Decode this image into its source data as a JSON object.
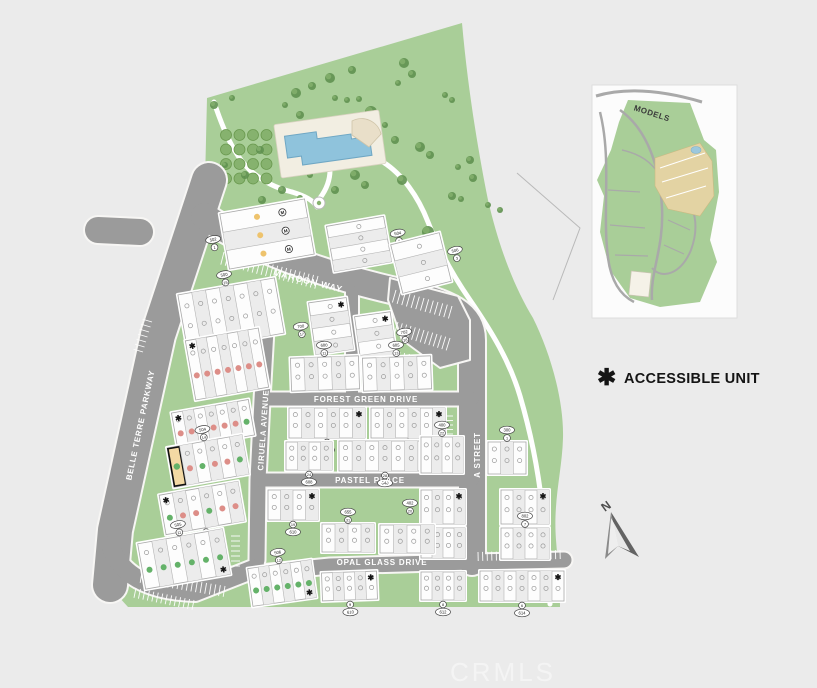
{
  "watermark": {
    "text": "CRMLS"
  },
  "legend": {
    "star": "✱",
    "label": "ACCESSIBLE UNIT"
  },
  "compass": {
    "label": "N"
  },
  "inset": {
    "title": "MODELS"
  },
  "streets": [
    {
      "name": "MAROON WAY"
    },
    {
      "name": "FOREST GREEN DRIVE"
    },
    {
      "name": "PASTEL PLACE"
    },
    {
      "name": "OPAL GLASS DRIVE"
    },
    {
      "name": "BELLE TERRE PARKWAY"
    },
    {
      "name": "CIRUELA AVENUE"
    },
    {
      "name": "A STREET"
    }
  ],
  "colors": {
    "background": "#ebebeb",
    "site_green": "#a9ce98",
    "road_gray": "#9b9b9b",
    "building_white": "#fdfdfd",
    "unit_alt": "#ececec",
    "sold_red": "#dd8e88",
    "available_green": "#64b269",
    "model_yellow": "#eec36d",
    "highlight_tan": "#f3d9a4",
    "pool_blue": "#8fc3dc",
    "deck_cream": "#f2eee2",
    "tree_dark": "#5f9150",
    "tree_light": "#86b26e",
    "accent_black": "#141414"
  },
  "map": {
    "buildings": [
      {
        "x": 224,
        "y": 206,
        "w": 86,
        "h": 56,
        "rot": -10,
        "o": "h",
        "n": 3,
        "dots": [
          "model",
          "model",
          "model"
        ],
        "lab": {
          "t": "502",
          "num": "1",
          "s": "left"
        }
      },
      {
        "x": 330,
        "y": 221,
        "w": 58,
        "h": 46,
        "rot": -10,
        "o": "h",
        "n": 4,
        "lab": {
          "t": "504",
          "num": "2",
          "s": "right"
        }
      },
      {
        "x": 396,
        "y": 238,
        "w": 50,
        "h": 50,
        "rot": -14,
        "o": "h",
        "n": 3,
        "lab": {
          "t": "506",
          "num": "3",
          "s": "right"
        }
      },
      {
        "x": 182,
        "y": 286,
        "w": 98,
        "h": 56,
        "rot": -10,
        "o": "v",
        "n": 7,
        "lab": {
          "t": "500",
          "num": "15",
          "s": "top"
        }
      },
      {
        "x": 312,
        "y": 300,
        "w": 38,
        "h": 52,
        "rot": -8,
        "o": "h",
        "n": 4,
        "star": "tr",
        "lab": {
          "t": "700",
          "num": "17",
          "s": "left"
        }
      },
      {
        "x": 358,
        "y": 314,
        "w": 36,
        "h": 52,
        "rot": -8,
        "o": "h",
        "n": 4,
        "star": "tr",
        "lab": {
          "t": "702",
          "num": "18",
          "s": "right"
        }
      },
      {
        "x": 190,
        "y": 334,
        "w": 74,
        "h": 60,
        "rot": -10,
        "o": "v",
        "n": 7,
        "dots": [
          "red",
          "red",
          "red",
          "red",
          "red",
          "red",
          "red"
        ],
        "star": "tl"
      },
      {
        "x": 174,
        "y": 406,
        "w": 78,
        "h": 36,
        "rot": -10,
        "o": "v",
        "n": 7,
        "dots": [
          "red",
          "red",
          "red",
          "red",
          "red",
          "red",
          "green"
        ],
        "star": "tl",
        "lab": {
          "t": "502",
          "num": "15",
          "s": "bottom"
        }
      },
      {
        "x": 170,
        "y": 441,
        "w": 76,
        "h": 40,
        "rot": -10,
        "o": "v",
        "n": 6,
        "dots": [
          "hl",
          "red",
          "green",
          "red",
          "red",
          "green"
        ],
        "lab": {
          "t": "504",
          "num": "14",
          "s": "top"
        }
      },
      {
        "x": 162,
        "y": 488,
        "w": 80,
        "h": 40,
        "rot": -10,
        "o": "v",
        "n": 6,
        "dots": [
          "green",
          "red",
          "red",
          "green",
          "red",
          "red"
        ],
        "star": "tl",
        "lab": {
          "t": "400",
          "num": "13",
          "s": "bottom"
        }
      },
      {
        "x": 141,
        "y": 536,
        "w": 86,
        "h": 46,
        "rot": -10,
        "o": "v",
        "n": 6,
        "dots": [
          "green",
          "green",
          "green",
          "green",
          "green",
          "green"
        ],
        "star": "br",
        "lab": {
          "t": "505",
          "num": "11",
          "s": "top"
        }
      },
      {
        "x": 291,
        "y": 357,
        "w": 68,
        "h": 33,
        "rot": -2,
        "o": "v",
        "n": 5,
        "lab": {
          "t": "600",
          "num": "11",
          "s": "top"
        }
      },
      {
        "x": 363,
        "y": 357,
        "w": 68,
        "h": 33,
        "rot": -2,
        "o": "v",
        "n": 5,
        "lab": {
          "t": "605",
          "num": "13",
          "s": "top"
        }
      },
      {
        "x": 289,
        "y": 408,
        "w": 76,
        "h": 30,
        "o": "v",
        "n": 6,
        "star": "tr",
        "lab": {
          "t": "600",
          "num": "26",
          "s": "bottom"
        }
      },
      {
        "x": 371,
        "y": 408,
        "w": 74,
        "h": 30,
        "o": "v",
        "n": 6,
        "star": "tr",
        "lab": {
          "t": "605",
          "num": "26",
          "s": "bottom"
        }
      },
      {
        "x": 286,
        "y": 442,
        "w": 46,
        "h": 28,
        "o": "v",
        "n": 4,
        "lab": {
          "t": "608",
          "num": "24",
          "s": "bottom"
        }
      },
      {
        "x": 339,
        "y": 441,
        "w": 92,
        "h": 30,
        "o": "v",
        "n": 7,
        "lab": {
          "t": "640",
          "num": "28",
          "s": "bottom"
        }
      },
      {
        "x": 421,
        "y": 437,
        "w": 42,
        "h": 36,
        "o": "v",
        "n": 4,
        "lab": {
          "t": "400",
          "num": "22",
          "s": "top"
        }
      },
      {
        "x": 488,
        "y": 442,
        "w": 38,
        "h": 32,
        "o": "v",
        "n": 3,
        "lab": {
          "t": "300",
          "num": "1",
          "s": "top"
        }
      },
      {
        "x": 421,
        "y": 490,
        "w": 44,
        "h": 34,
        "o": "v",
        "n": 4,
        "star": "tr",
        "lab": {
          "t": "402",
          "num": "20",
          "s": "left"
        }
      },
      {
        "x": 421,
        "y": 528,
        "w": 44,
        "h": 30,
        "o": "v",
        "n": 4
      },
      {
        "x": 501,
        "y": 490,
        "w": 48,
        "h": 34,
        "o": "v",
        "n": 4,
        "star": "tr",
        "lab": {
          "t": "800",
          "num": "4",
          "s": "bottom"
        }
      },
      {
        "x": 501,
        "y": 528,
        "w": 48,
        "h": 31,
        "o": "v",
        "n": 4,
        "lab": {
          "t": "802",
          "num": "7",
          "s": "top"
        }
      },
      {
        "x": 268,
        "y": 490,
        "w": 50,
        "h": 30,
        "o": "v",
        "n": 4,
        "star": "tr",
        "lab": {
          "t": "610",
          "num": "19",
          "s": "bottom"
        }
      },
      {
        "x": 322,
        "y": 524,
        "w": 52,
        "h": 28,
        "o": "v",
        "n": 4,
        "lab": {
          "t": "655",
          "num": "31",
          "s": "top"
        }
      },
      {
        "x": 380,
        "y": 525,
        "w": 54,
        "h": 28,
        "o": "v",
        "n": 4
      },
      {
        "x": 250,
        "y": 564,
        "w": 64,
        "h": 38,
        "rot": -8,
        "o": "v",
        "n": 6,
        "dots": [
          "green",
          "green",
          "green",
          "green",
          "green",
          "green"
        ],
        "star": "br",
        "lab": {
          "t": "506",
          "num": "12",
          "s": "top"
        }
      },
      {
        "x": 322,
        "y": 572,
        "w": 55,
        "h": 28,
        "rot": -2,
        "o": "v",
        "n": 5,
        "star": "tr",
        "lab": {
          "t": "610",
          "num": "9",
          "s": "bottom"
        }
      },
      {
        "x": 421,
        "y": 572,
        "w": 44,
        "h": 28,
        "o": "v",
        "n": 4,
        "lab": {
          "t": "612",
          "num": "8",
          "s": "bottom"
        }
      },
      {
        "x": 480,
        "y": 571,
        "w": 84,
        "h": 30,
        "o": "v",
        "n": 7,
        "star": "tr",
        "lab": {
          "t": "614",
          "num": "6",
          "s": "bottom"
        }
      }
    ]
  }
}
